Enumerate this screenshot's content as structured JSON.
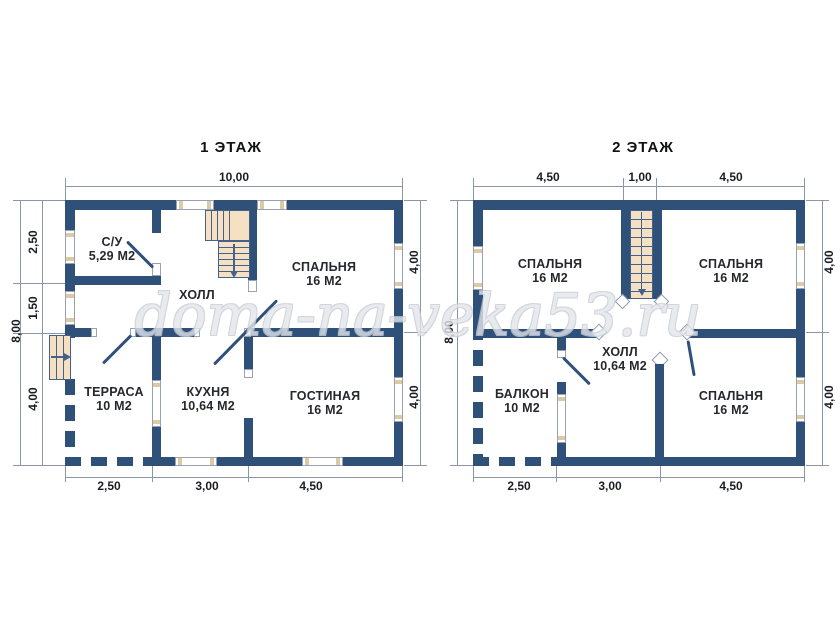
{
  "watermark": "doma-na-veka53.ru",
  "colors": {
    "wall_navy": "#2f5078",
    "stair_peach": "#f5e0c3",
    "watermark_gray": "#c6ccd6"
  },
  "floor1": {
    "title": "1 ЭТАЖ",
    "rooms": {
      "su": {
        "name": "С/У",
        "area": "5,29 М2"
      },
      "hall": {
        "name": "ХОЛЛ"
      },
      "bedroom": {
        "name": "СПАЛЬНЯ",
        "area": "16 М2"
      },
      "terrace": {
        "name": "ТЕРРАСА",
        "area": "10 М2"
      },
      "kitchen": {
        "name": "КУХНЯ",
        "area": "10,64 М2"
      },
      "living": {
        "name": "ГОСТИНАЯ",
        "area": "16 М2"
      }
    },
    "dims": {
      "top_total": "10,00",
      "left_total": "8,00",
      "left": [
        "2,50",
        "1,50",
        "4,00"
      ],
      "right": [
        "4,00",
        "4,00"
      ],
      "bottom": [
        "2,50",
        "3,00",
        "4,50"
      ]
    }
  },
  "floor2": {
    "title": "2 ЭТАЖ",
    "rooms": {
      "bedroom_left": {
        "name": "СПАЛЬНЯ",
        "area": "16 М2"
      },
      "bedroom_right": {
        "name": "СПАЛЬНЯ",
        "area": "16 М2"
      },
      "hall": {
        "name": "ХОЛЛ",
        "area": "10,64 М2"
      },
      "balcony": {
        "name": "БАЛКОН",
        "area": "10 М2"
      },
      "bedroom_bottom": {
        "name": "СПАЛЬНЯ",
        "area": "16 М2"
      }
    },
    "dims": {
      "top": [
        "4,50",
        "1,00",
        "4,50"
      ],
      "left_total": "8,00",
      "right": [
        "4,00",
        "4,00"
      ],
      "bottom": [
        "2,50",
        "3,00",
        "4,50"
      ]
    }
  }
}
